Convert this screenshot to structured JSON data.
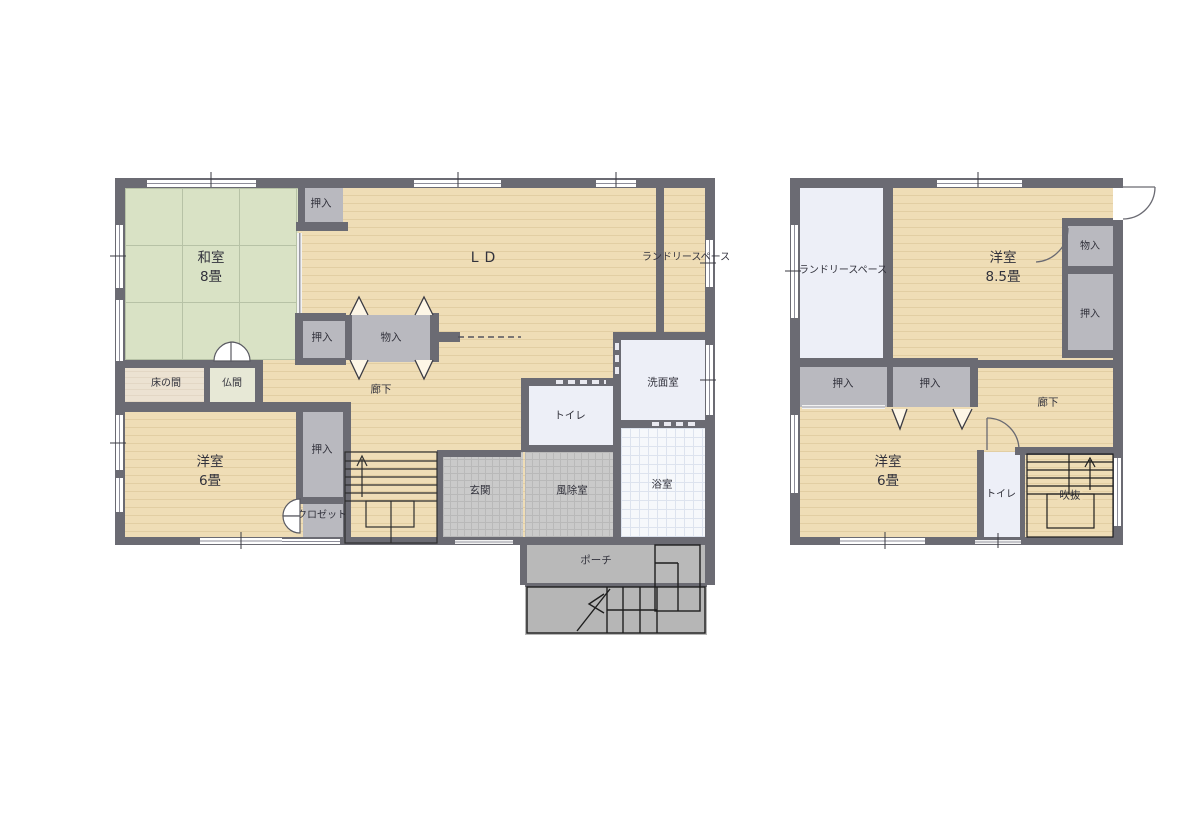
{
  "colors": {
    "wall": "#6b6b73",
    "wood_floor": "#efddb6",
    "wood_stripe": "#e2cea3",
    "tatami_green": "#d9e2c5",
    "closet_gray": "#b9b9bf",
    "white_room": "#edeff7",
    "bath_grid": "#dde3ee",
    "entry_tile": "#cacaca",
    "porch_gray": "#b9b9b9",
    "tokonoma_cream": "#ece2d2",
    "butsuma_cream": "#e7e8d6",
    "text": "#32323c"
  },
  "floor1": {
    "rooms": {
      "washitsu": {
        "name": "和室",
        "size": "8畳"
      },
      "oshiire_top": {
        "name": "押入"
      },
      "ld": {
        "name": "LD"
      },
      "laundry": {
        "name": "ランドリースペース"
      },
      "oshiire_mid": {
        "name": "押入"
      },
      "monoire": {
        "name": "物入"
      },
      "tokonoma": {
        "name": "床の間"
      },
      "butsuma": {
        "name": "仏間"
      },
      "rouka": {
        "name": "廊下"
      },
      "senmen": {
        "name": "洗面室"
      },
      "toilet": {
        "name": "トイレ"
      },
      "yoshitsu6": {
        "name": "洋室",
        "size": "6畳"
      },
      "oshiire_low": {
        "name": "押入"
      },
      "closet": {
        "name": "クロゼット"
      },
      "genkan": {
        "name": "玄関"
      },
      "fujo": {
        "name": "風除室"
      },
      "bath": {
        "name": "浴室"
      },
      "porch": {
        "name": "ポーチ"
      }
    }
  },
  "floor2": {
    "rooms": {
      "laundry": {
        "name": "ランドリースペース"
      },
      "yoshitsu85": {
        "name": "洋室",
        "size": "8.5畳"
      },
      "monoire": {
        "name": "物入"
      },
      "oshiire_right": {
        "name": "押入"
      },
      "oshiire_b1": {
        "name": "押入"
      },
      "oshiire_b2": {
        "name": "押入"
      },
      "rouka": {
        "name": "廊下"
      },
      "yoshitsu6": {
        "name": "洋室",
        "size": "6畳"
      },
      "toilet": {
        "name": "トイレ"
      },
      "fukinuke": {
        "name": "吹抜"
      }
    }
  }
}
